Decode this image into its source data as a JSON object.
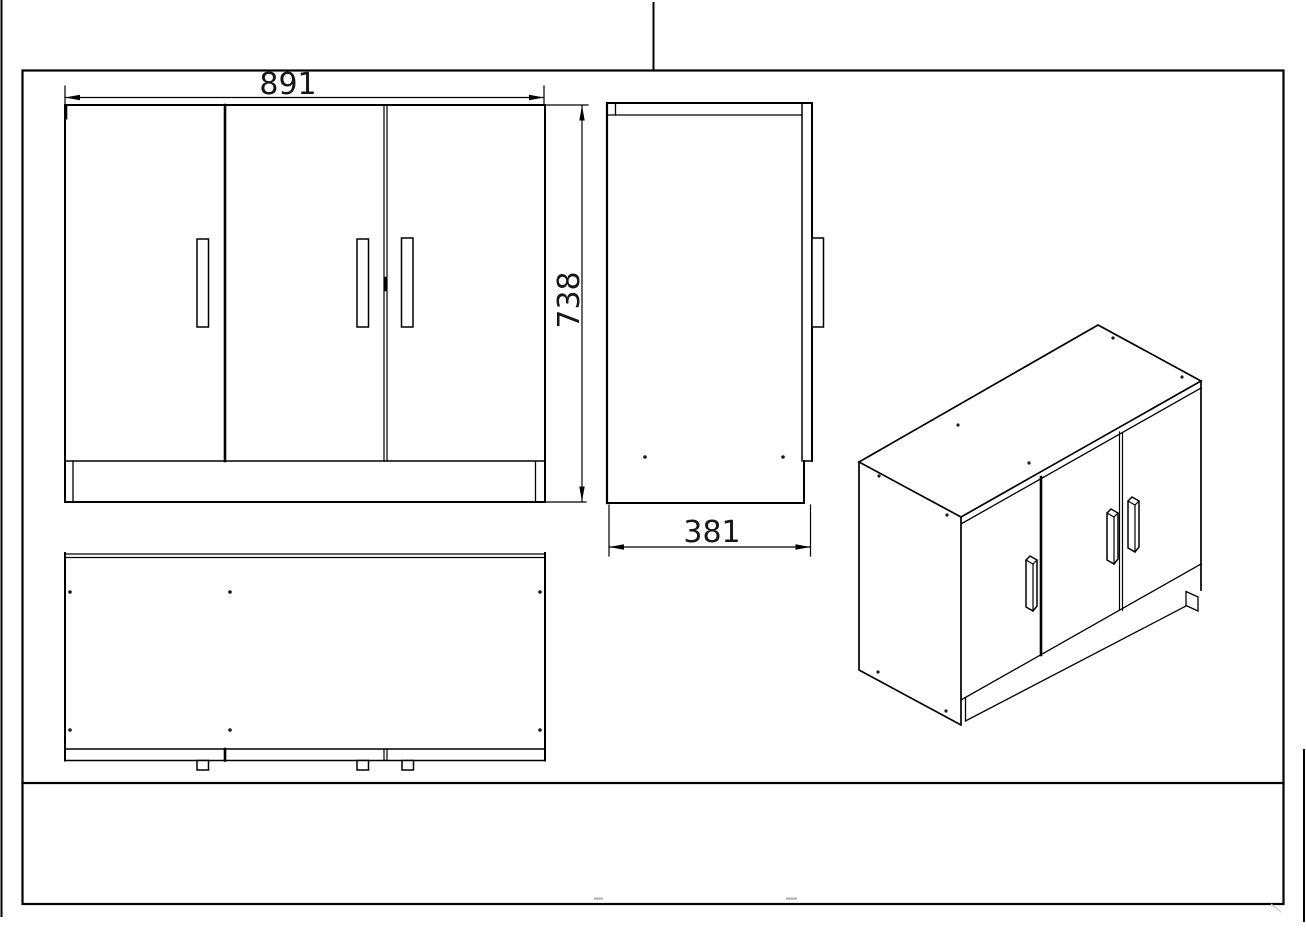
{
  "colors": {
    "background": "#ffffff",
    "ink": "#000000",
    "faint_mark": "#b5b5b5"
  },
  "dimensions": {
    "width_mm": "891",
    "height_mm": "738",
    "depth_mm": "381"
  }
}
